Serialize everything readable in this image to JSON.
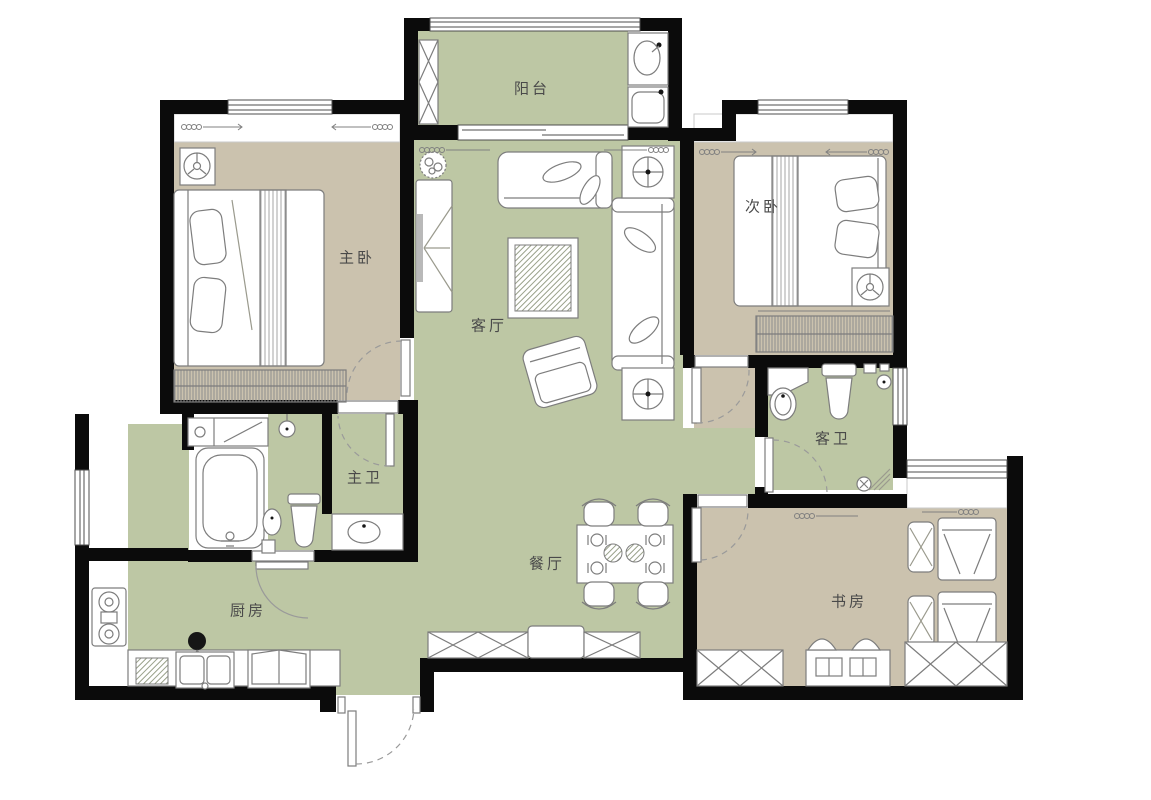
{
  "palette": {
    "wall": "#0b0b0b",
    "floor_living": "#bdc7a4",
    "floor_bedroom": "#cbc2ae",
    "floor_white": "#ffffff",
    "furniture_outline": "#7d7d7d",
    "door_arc": "#9a9a9a",
    "label_text": "#4a4a4a",
    "background": "#ffffff"
  },
  "rooms": [
    {
      "id": "balcony",
      "label": "阳台"
    },
    {
      "id": "master-bedroom",
      "label": "主卧"
    },
    {
      "id": "second-bedroom",
      "label": "次卧"
    },
    {
      "id": "living-room",
      "label": "客厅"
    },
    {
      "id": "master-bathroom",
      "label": "主卫"
    },
    {
      "id": "guest-bathroom",
      "label": "客卫"
    },
    {
      "id": "kitchen",
      "label": "厨房"
    },
    {
      "id": "dining-room",
      "label": "餐厅"
    },
    {
      "id": "study",
      "label": "书房"
    }
  ],
  "furniture_icons": [
    "double-bed-icon",
    "wardrobe-icon",
    "sofa-icon",
    "armchair-icon",
    "coffee-table-icon",
    "tv-cabinet-icon",
    "plant-icon",
    "floor-lamp-icon",
    "dining-table-icon",
    "chair-icon",
    "bathtub-icon",
    "toilet-icon",
    "washbasin-icon",
    "shower-icon",
    "floor-drain-icon",
    "stove-icon",
    "kitchen-sink-icon",
    "fridge-icon",
    "cutting-board-icon",
    "washing-machine-icon",
    "recliner-icon",
    "desk-icon",
    "bookcase-icon",
    "shoe-cabinet-icon",
    "ceiling-fixture-icon",
    "curtain-icon",
    "door-swing-icon",
    "window-icon",
    "sliding-door-icon"
  ]
}
